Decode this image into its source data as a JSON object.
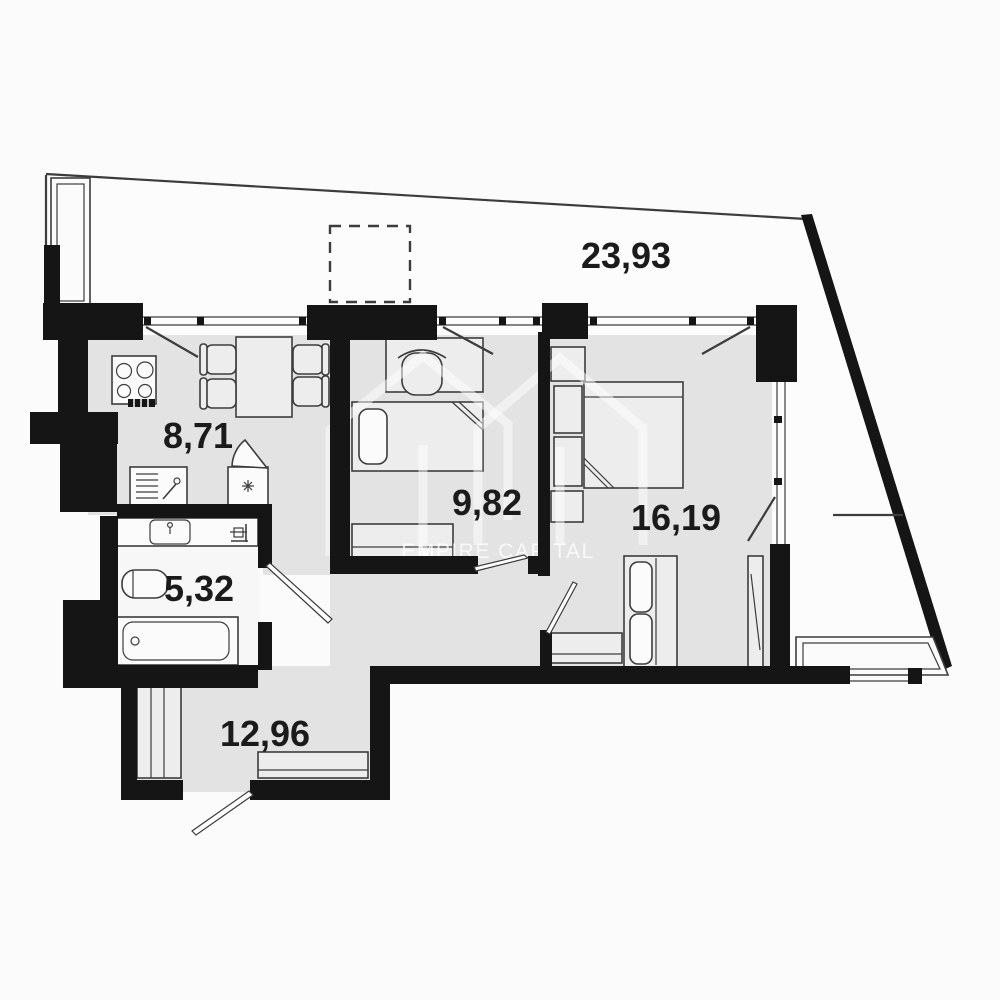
{
  "colors": {
    "bg": "#fbfbfb",
    "terrace": "#fcfcfc",
    "floor": "#e3e3e3",
    "bath_floor": "#f7f7f7",
    "furniture": "#ededed",
    "fixture": "#fbfbfb",
    "wall": "#151515",
    "line": "#3c3c3c",
    "label": "#1b1b1b",
    "watermark": "#ffffff"
  },
  "plan": {
    "type": "apartment-floor-plan",
    "rooms": [
      {
        "id": "terrace",
        "area_label": "23,93"
      },
      {
        "id": "kitchen-living",
        "area_label": "8,71"
      },
      {
        "id": "bedroom-small",
        "area_label": "9,82"
      },
      {
        "id": "bedroom-master",
        "area_label": "16,19"
      },
      {
        "id": "bathroom",
        "area_label": "5,32"
      },
      {
        "id": "hallway",
        "area_label": "12,96"
      }
    ]
  },
  "watermark": {
    "text": "EMPIRE CAPITAL"
  }
}
